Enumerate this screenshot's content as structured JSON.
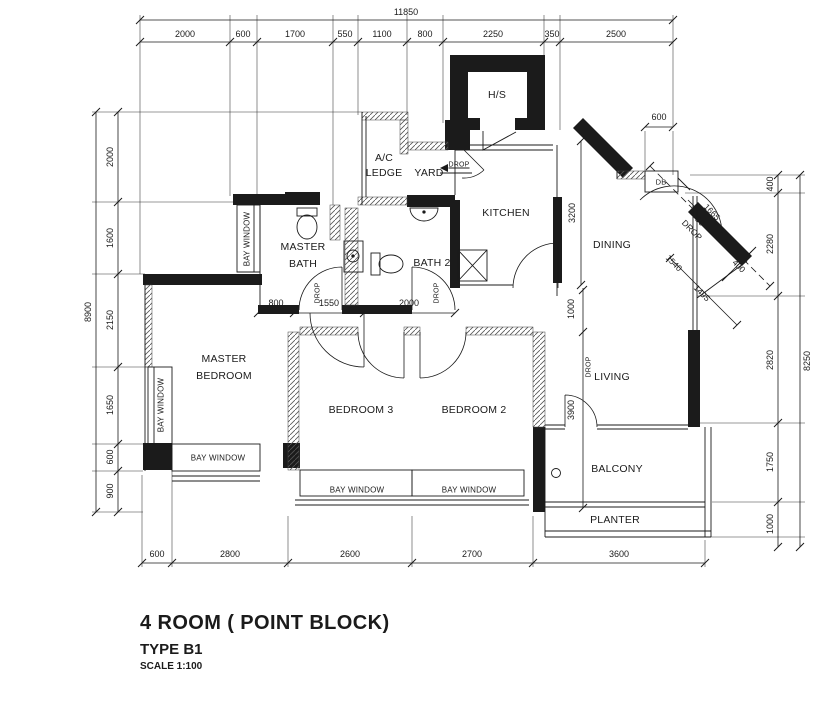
{
  "title": {
    "main": "4 ROOM ( POINT BLOCK)",
    "type": "TYPE B1",
    "scale": "SCALE 1:100"
  },
  "rooms": {
    "hs": "H/S",
    "ac_line1": "A/C",
    "ac_line2": "LEDGE",
    "yard": "YARD",
    "kitchen": "KITCHEN",
    "dining": "DINING",
    "master_bath_line1": "MASTER",
    "master_bath_line2": "BATH",
    "bath2": "BATH 2",
    "master_bedroom_line1": "MASTER",
    "master_bedroom_line2": "BEDROOM",
    "bedroom3": "BEDROOM 3",
    "bedroom2": "BEDROOM 2",
    "living": "LIVING",
    "balcony": "BALCONY",
    "planter": "PLANTER",
    "db": "DB"
  },
  "labels": {
    "bay_window": "BAY WINDOW",
    "drop": "DROP"
  },
  "dimensions": {
    "top_total": "11850",
    "top": [
      "2000",
      "600",
      "1700",
      "550",
      "1100",
      "800",
      "2250",
      "350",
      "2500"
    ],
    "left_total": "8900",
    "left": [
      "2000",
      "1600",
      "2150",
      "1650",
      "600",
      "900"
    ],
    "right": [
      "400",
      "2280",
      "2820",
      "1750",
      "1000"
    ],
    "right_total": "8250",
    "bottom": [
      "600",
      "2800",
      "2600",
      "2700",
      "3600"
    ],
    "hall": [
      "800",
      "1550",
      "2000"
    ],
    "kitchen_side": "3200",
    "living_top": "1000",
    "living_side": "3900",
    "niche": "600",
    "diag_dashed": "1665",
    "diag_drop_value": "50",
    "diag_wall": "1495",
    "diag_width": "400",
    "diag_door": "1540"
  },
  "colors": {
    "ink": "#1b1b1b",
    "paper": "#ffffff"
  }
}
